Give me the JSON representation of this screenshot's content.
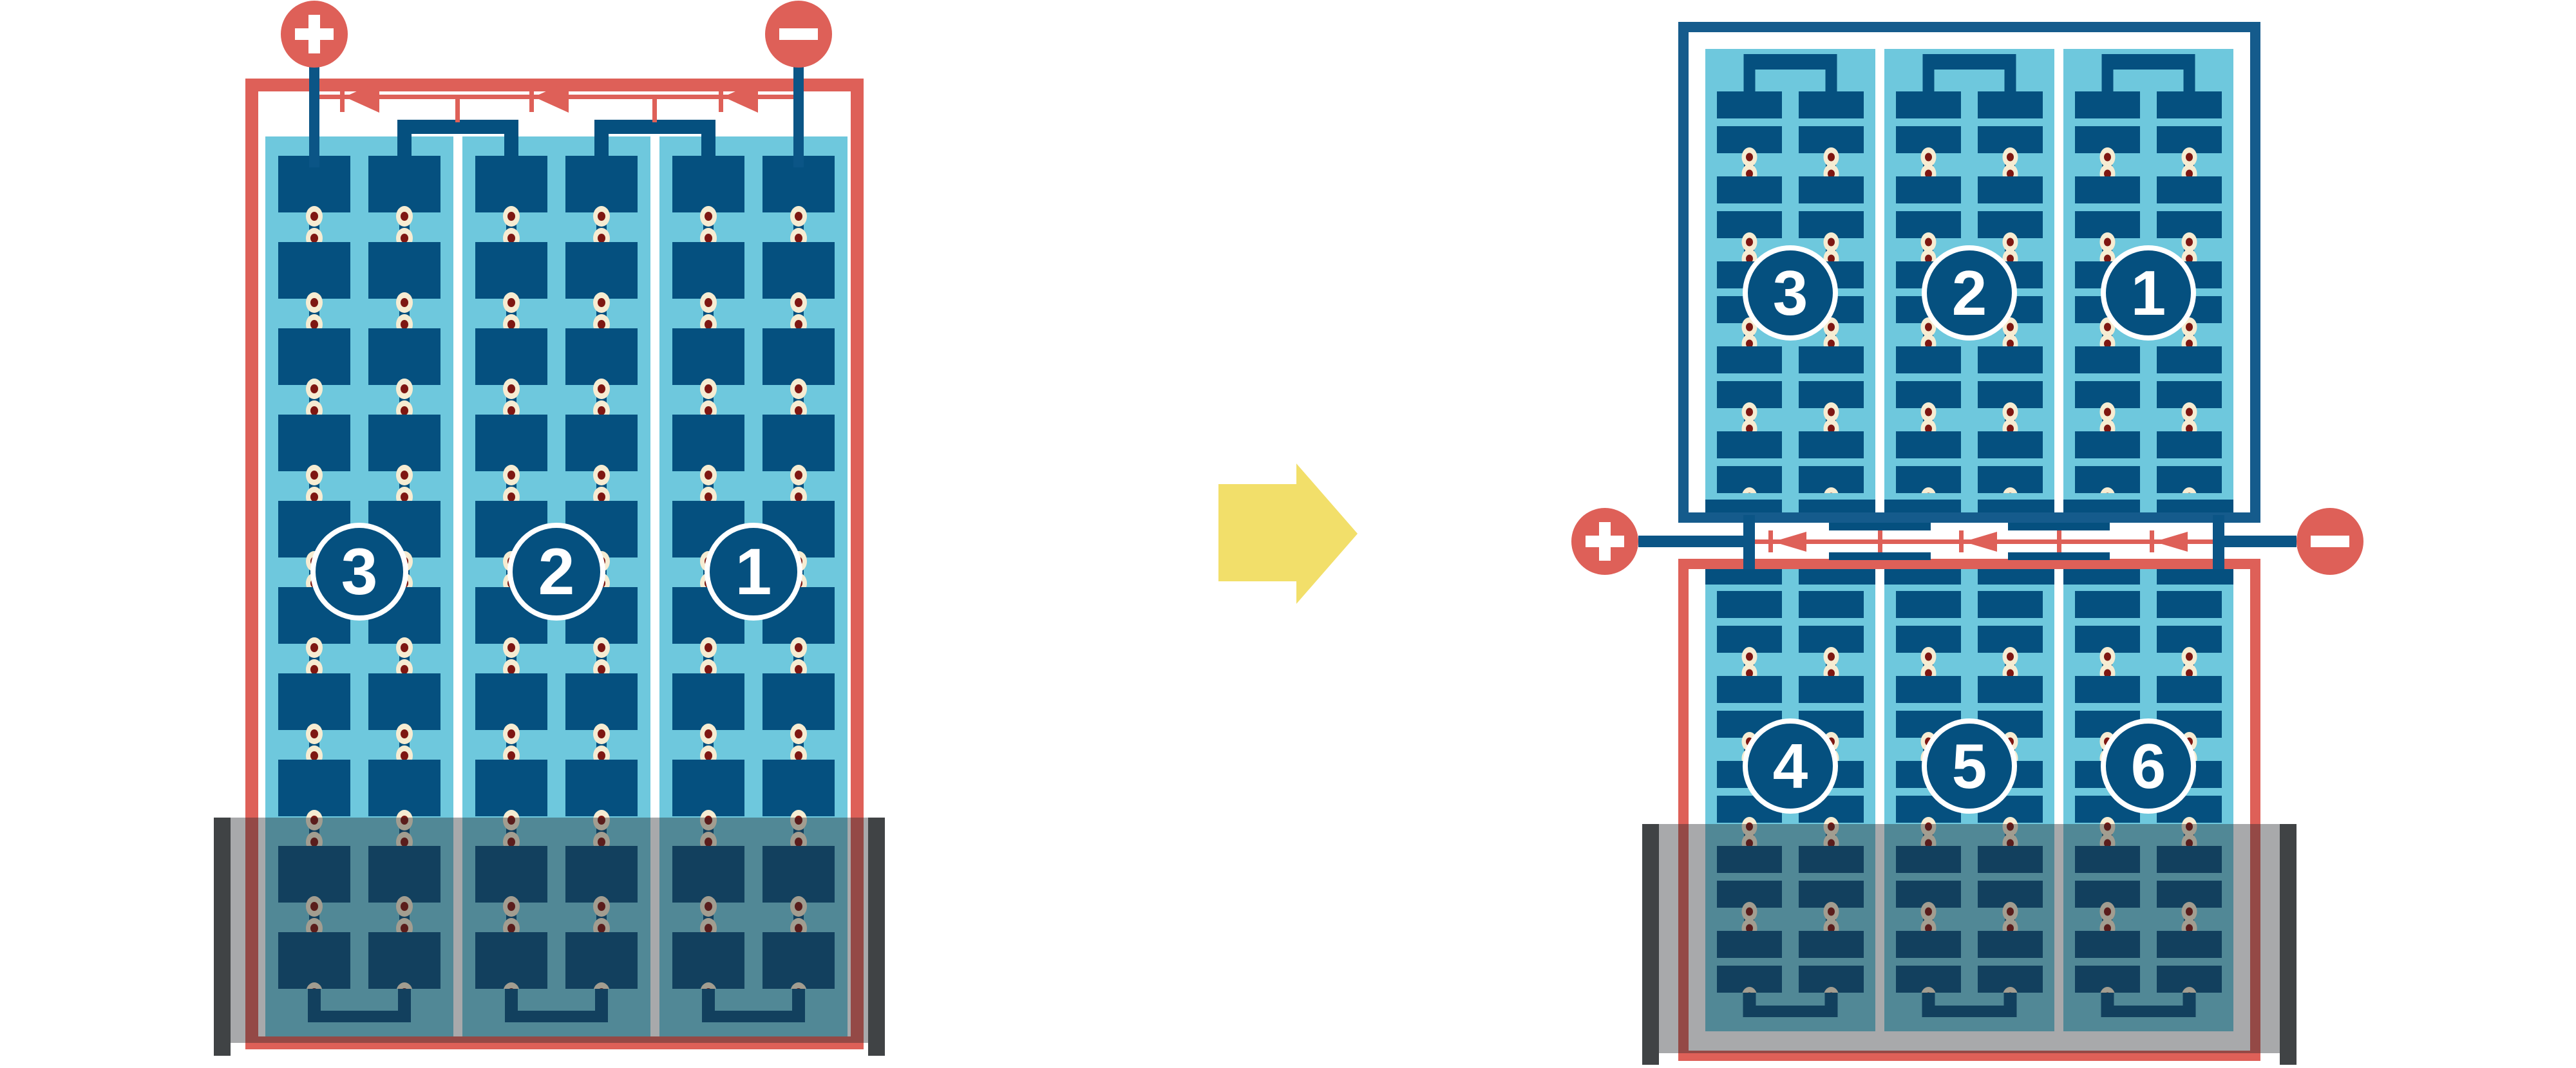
{
  "left_diagram": {
    "strings": [
      "3",
      "2",
      "1"
    ],
    "terminals": {
      "positive": "+",
      "negative": "−"
    },
    "bypass_diode_count": 3,
    "flooded": true
  },
  "right_diagram": {
    "top_strings": [
      "3",
      "2",
      "1"
    ],
    "bottom_strings": [
      "4",
      "5",
      "6"
    ],
    "terminals": {
      "positive": "+",
      "negative": "−"
    },
    "bypass_diode_count": 3,
    "flooded": true
  },
  "icons": {
    "transition": "block-arrow-right",
    "positive_terminal": "plus-icon",
    "negative_terminal": "minus-icon",
    "diode": "left-pointing-diode"
  },
  "colors": {
    "red": "#DE6058",
    "cell_blue": "#05507F",
    "frame_blue": "#155B8C",
    "light_blue": "#6EC8DD",
    "solder_cream": "#F6ECD2",
    "solder_dot": "#7E1712",
    "arrow_yellow": "#F2DF6A",
    "flood_overlay": "rgba(38,41,45,0.40)",
    "flood_edge_gray": "#404345",
    "background": "#ffffff"
  }
}
